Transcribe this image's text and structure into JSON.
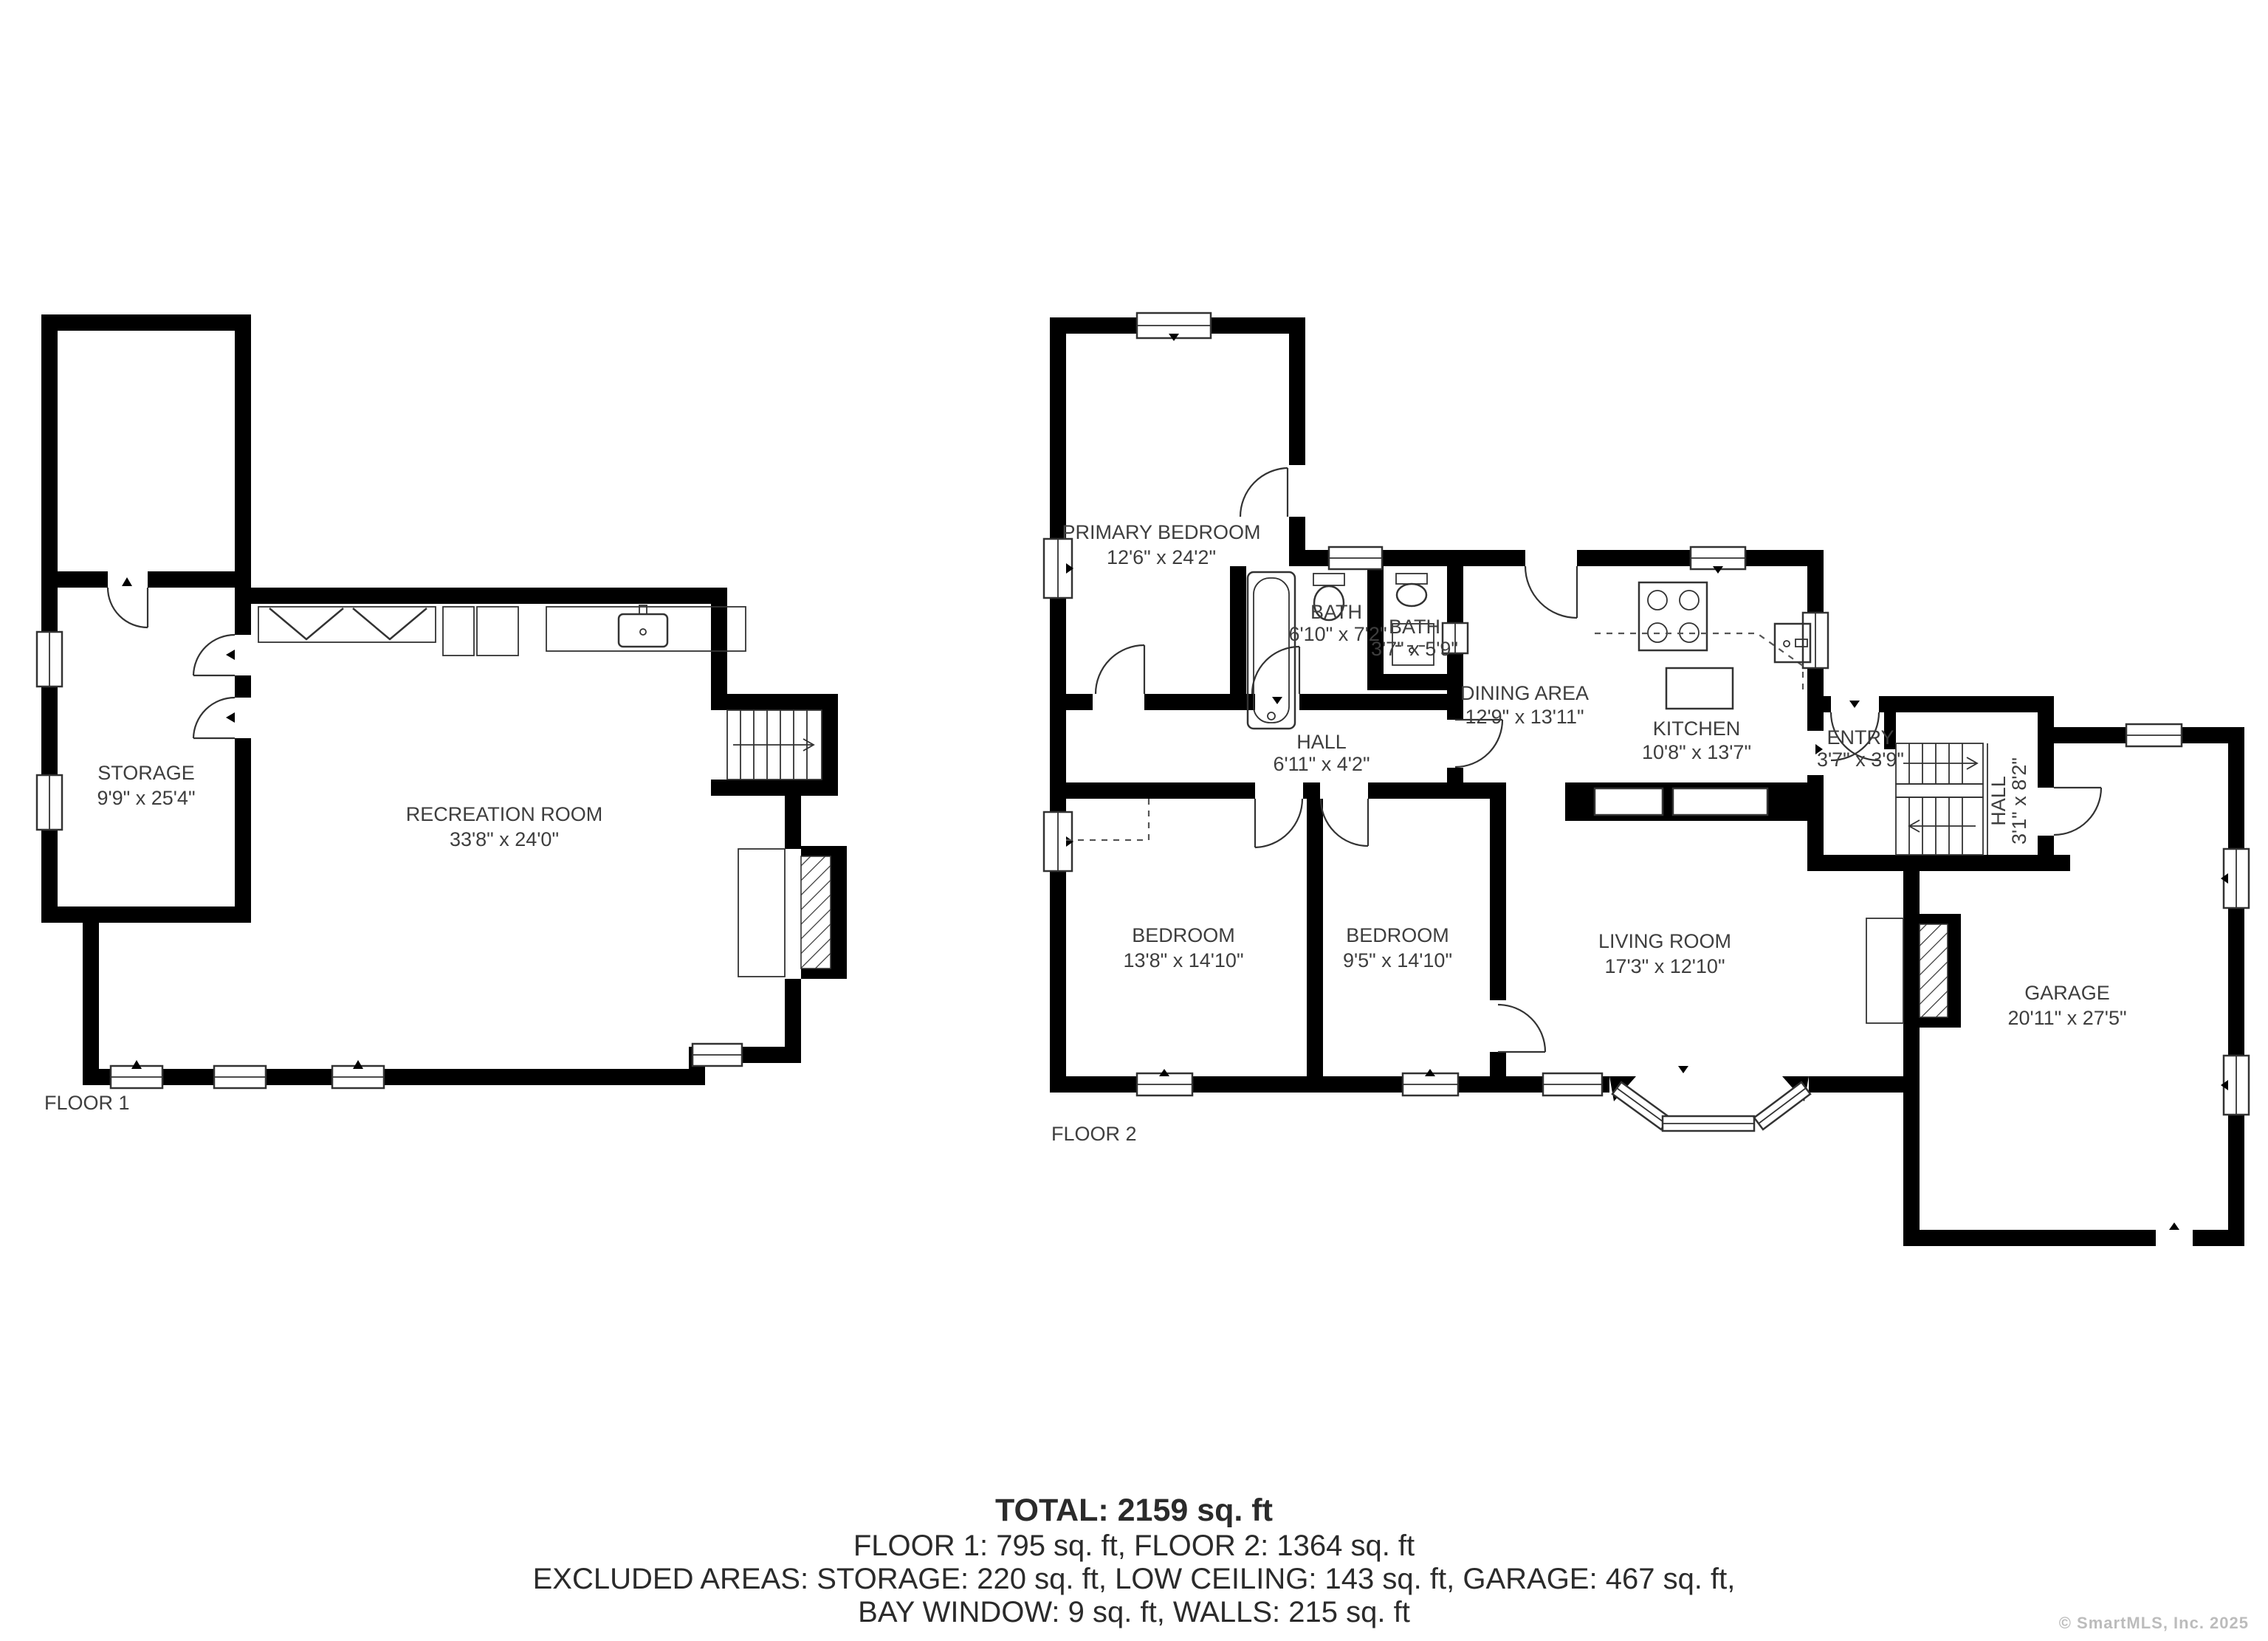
{
  "colors": {
    "wall": "#000000",
    "line": "#333333",
    "text": "#3e3e3e",
    "watermark": "#bcbcbc"
  },
  "floor1": {
    "label": "FLOOR 1",
    "rooms": {
      "storage": {
        "name": "STORAGE",
        "dims": "9'9\" x 25'4\""
      },
      "recreation": {
        "name": "RECREATION ROOM",
        "dims": "33'8\" x 24'0\""
      }
    }
  },
  "floor2": {
    "label": "FLOOR 2",
    "rooms": {
      "primary": {
        "name": "PRIMARY BEDROOM",
        "dims": "12'6\" x 24'2\""
      },
      "bath1": {
        "name": "BATH",
        "dims": "6'10\" x 7'2\""
      },
      "bath2": {
        "name": "BATH",
        "dims": "3'7\" x 5'9\""
      },
      "hall": {
        "name": "HALL",
        "dims": "6'11\" x 4'2\""
      },
      "dining": {
        "name": "DINING AREA",
        "dims": "12'9\" x 13'11\""
      },
      "kitchen": {
        "name": "KITCHEN",
        "dims": "10'8\" x 13'7\""
      },
      "entry": {
        "name": "ENTRY",
        "dims": "3'7\" x 3'9\""
      },
      "hall2": {
        "name": "HALL",
        "dims": "3'1\" x 8'2\""
      },
      "bedroom1": {
        "name": "BEDROOM",
        "dims": "13'8\" x 14'10\""
      },
      "bedroom2": {
        "name": "BEDROOM",
        "dims": "9'5\" x 14'10\""
      },
      "living": {
        "name": "LIVING ROOM",
        "dims": "17'3\" x 12'10\""
      },
      "garage": {
        "name": "GARAGE",
        "dims": "20'11\" x 27'5\""
      }
    }
  },
  "summary": {
    "total": "TOTAL: 2159 sq. ft",
    "floors": "FLOOR 1: 795 sq. ft, FLOOR 2: 1364 sq. ft",
    "excluded_line1": "EXCLUDED AREAS: STORAGE: 220 sq. ft, LOW CEILING: 143 sq. ft, GARAGE: 467 sq. ft,",
    "excluded_line2": "BAY WINDOW: 9 sq. ft, WALLS: 215 sq. ft"
  },
  "watermark": "© SmartMLS, Inc. 2025"
}
